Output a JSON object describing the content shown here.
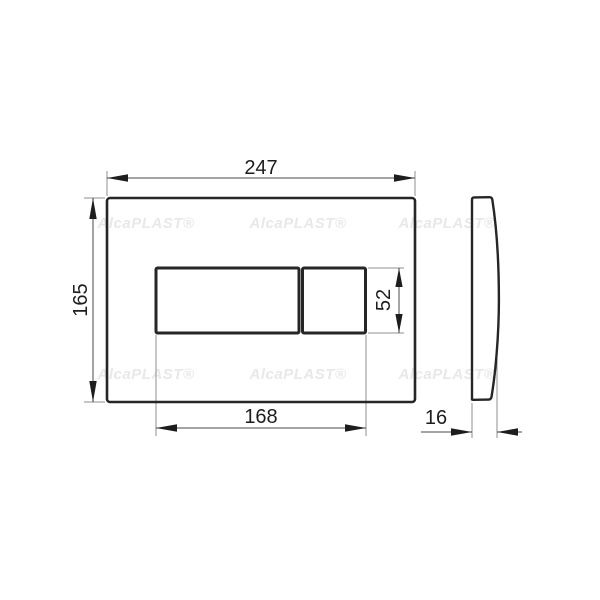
{
  "watermark": {
    "text": "AlcaPLAST®",
    "color": "#e8e8e8"
  },
  "dims": {
    "plate_width": "247",
    "plate_height": "165",
    "button_area_width": "168",
    "button_area_height": "52",
    "plate_thickness": "16"
  },
  "colors": {
    "outline": "#262626",
    "dimension_line": "#4a4a4a",
    "extension_line": "#8f8f8f",
    "text": "#1d1d1d",
    "background": "#ffffff"
  }
}
